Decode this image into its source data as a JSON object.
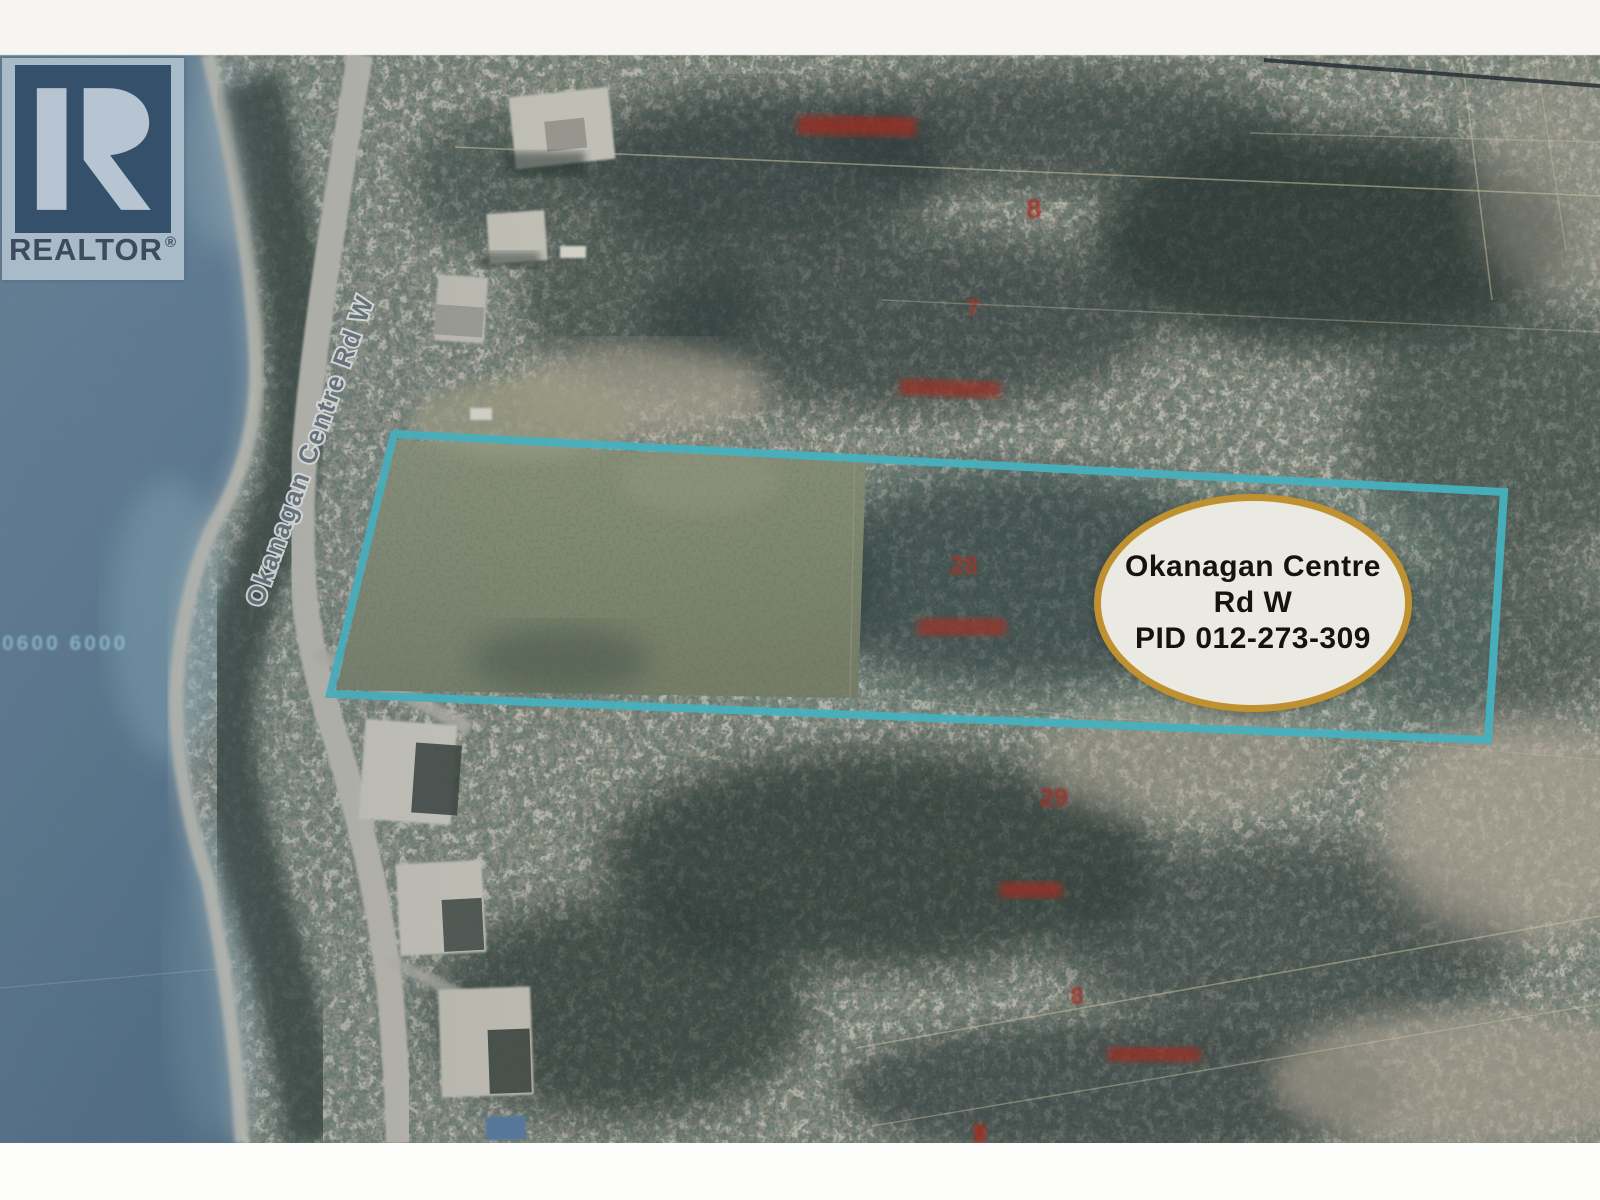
{
  "branding": {
    "realtor_word": "REALTOR",
    "registered": "®"
  },
  "map": {
    "road_label": "Okanagan Centre Rd W",
    "water_sounding": "0600 6000",
    "property_badge": {
      "line1": "Okanagan Centre",
      "line2": "Rd W",
      "line3": "PID 012-273-309"
    }
  },
  "annotations": {
    "lot_numbers": [
      {
        "text": "8"
      },
      {
        "text": "7"
      },
      {
        "text": "28"
      },
      {
        "text": "29"
      },
      {
        "text": "8"
      }
    ]
  },
  "colors": {
    "boundary_teal": "#44b5c2",
    "badge_border_gold": "#bf9130",
    "badge_fill": "#ebeae2",
    "annotation_red": "#a82a1f",
    "water_blue": "#5e7c92",
    "sounding_blue": "#9fd0e2"
  }
}
